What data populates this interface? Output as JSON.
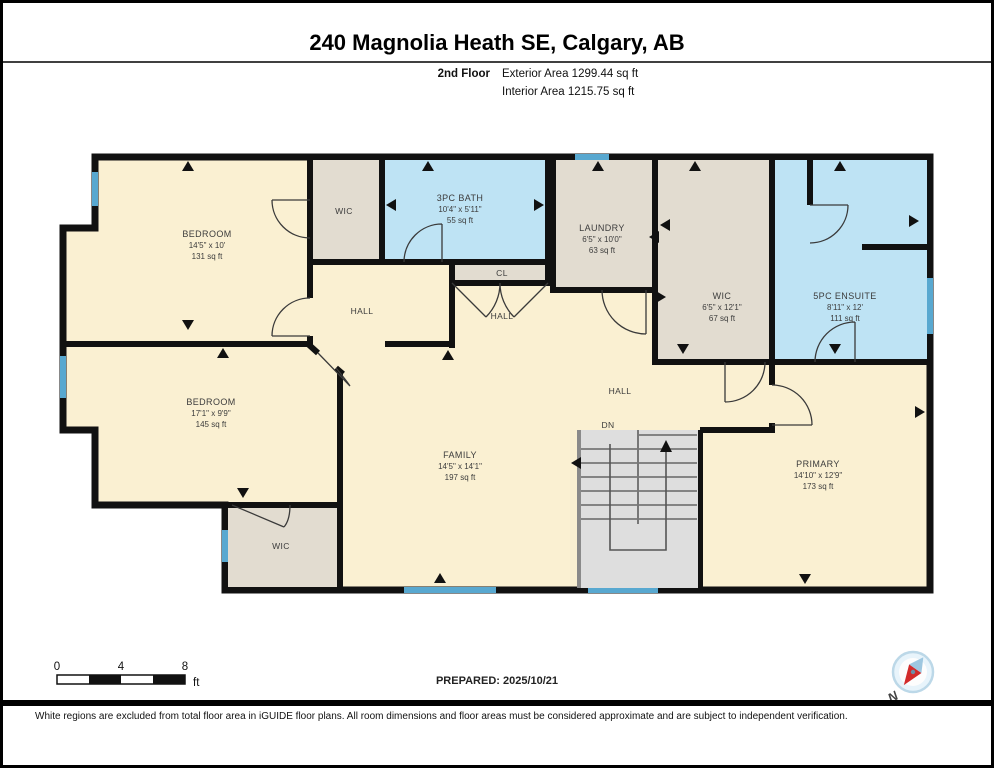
{
  "header": {
    "title": "240 Magnolia Heath SE, Calgary, AB",
    "floor": "2nd Floor",
    "exterior": "Exterior Area 1299.44 sq ft",
    "interior": "Interior Area 1215.75 sq ft"
  },
  "rooms": {
    "bedroom1": {
      "name": "BEDROOM",
      "dims": "14'5\" x 10'",
      "area": "131 sq ft"
    },
    "wic_top": {
      "name": "WIC"
    },
    "bath": {
      "name": "3PC BATH",
      "dims": "10'4\" x 5'11\"",
      "area": "55 sq ft"
    },
    "cl": {
      "name": "CL"
    },
    "laundry": {
      "name": "LAUNDRY",
      "dims": "6'5\" x 10'0\"",
      "area": "63 sq ft"
    },
    "wic_mid": {
      "name": "WIC",
      "dims": "6'5\" x 12'1\"",
      "area": "67 sq ft"
    },
    "ensuite": {
      "name": "5PC ENSUITE",
      "dims": "8'11\" x 12'",
      "area": "111 sq ft"
    },
    "hall_left": {
      "name": "HALL"
    },
    "hall_mid": {
      "name": "HALL"
    },
    "hall_right": {
      "name": "HALL"
    },
    "stairs": {
      "label": "DN"
    },
    "bedroom2": {
      "name": "BEDROOM",
      "dims": "17'1\" x 9'9\"",
      "area": "145 sq ft"
    },
    "family": {
      "name": "FAMILY",
      "dims": "14'5\" x 14'1\"",
      "area": "197 sq ft"
    },
    "wic_bottom": {
      "name": "WIC"
    },
    "primary": {
      "name": "PRIMARY",
      "dims": "14'10\" x 12'9\"",
      "area": "173 sq ft"
    }
  },
  "footer": {
    "scale_0": "0",
    "scale_4": "4",
    "scale_8": "8",
    "scale_unit": "ft",
    "prepared": "PREPARED: 2025/10/21",
    "compass": "N",
    "disclaimer": "White regions are excluded from total floor area in iGUIDE floor plans. All room dimensions and floor areas must be considered approximate and are subject to independent verification."
  },
  "colors": {
    "wall": "#111111",
    "floor": "#FAF0D2",
    "closet": "#E2DCD0",
    "bath": "#BEE3F4",
    "stairs": "#DEDEDE",
    "window": "#58A8D0",
    "compass_needle": "#D22B2B"
  }
}
